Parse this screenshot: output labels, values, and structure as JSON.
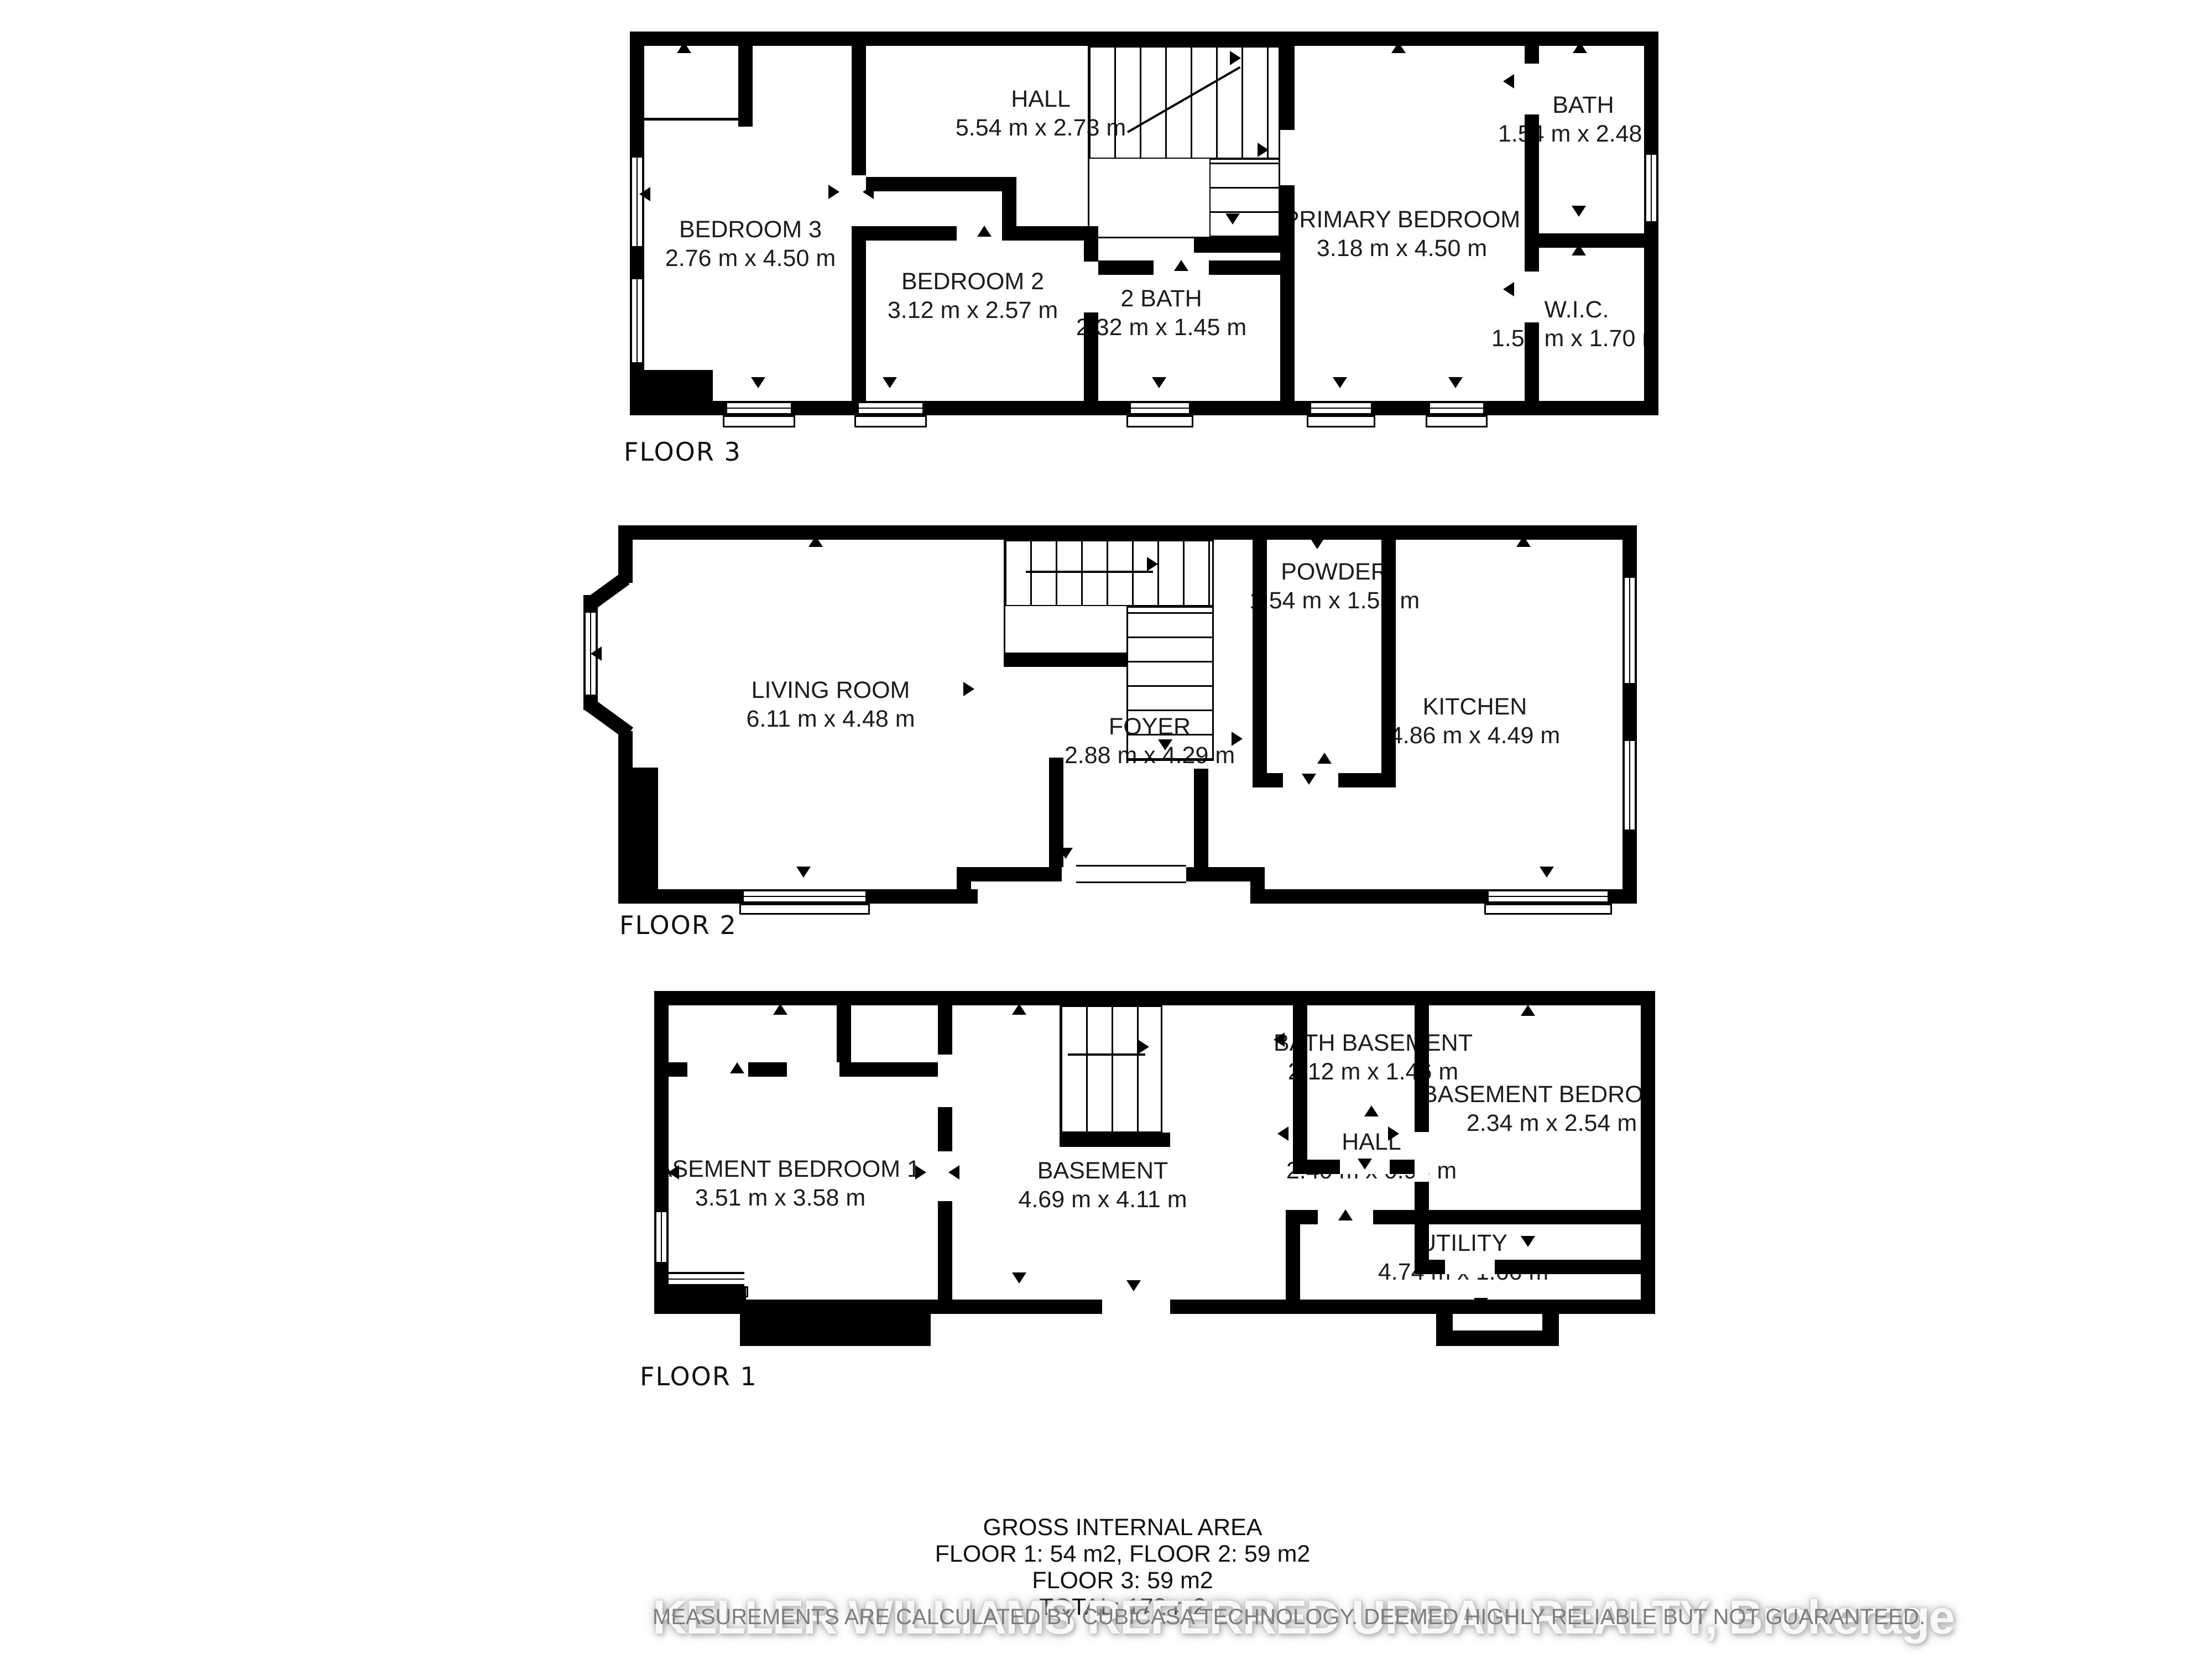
{
  "floors": [
    {
      "label": "FLOOR 3",
      "rooms": [
        {
          "name": "HALL",
          "dims": "5.54 m x 2.73 m"
        },
        {
          "name": "BEDROOM 3",
          "dims": "2.76 m x 4.50 m"
        },
        {
          "name": "BEDROOM 2",
          "dims": "3.12 m x 2.57 m"
        },
        {
          "name": "2 BATH",
          "dims": "2.32 m x 1.45 m"
        },
        {
          "name": "PRIMARY BEDROOM",
          "dims": "3.18 m x 4.50 m"
        },
        {
          "name": "BATH",
          "dims": "1.54 m x 2.48 m"
        },
        {
          "name": "W.I.C.",
          "dims": "1.54 m x 1.70 m"
        }
      ]
    },
    {
      "label": "FLOOR 2",
      "rooms": [
        {
          "name": "LIVING ROOM",
          "dims": "6.11 m x 4.48 m"
        },
        {
          "name": "FOYER",
          "dims": "2.88 m x 4.29 m"
        },
        {
          "name": "POWDER",
          "dims": "1.54 m x 1.55 m"
        },
        {
          "name": "KITCHEN",
          "dims": "4.86 m x 4.49 m"
        }
      ]
    },
    {
      "label": "FLOOR 1",
      "rooms": [
        {
          "name": "BASEMENT BEDROOM 1",
          "dims": "3.51 m x 3.58 m"
        },
        {
          "name": "BASEMENT",
          "dims": "4.69 m x 4.11 m"
        },
        {
          "name": "BATH BASEMENT",
          "dims": "2.12 m x 1.46 m"
        },
        {
          "name": "BASEMENT BEDROOM",
          "dims": "2.34 m x 2.54 m"
        },
        {
          "name": "HALL",
          "dims": "2.40 m x 0.98 m"
        },
        {
          "name": "UTILITY",
          "dims": "4.74 m x 1.66 m"
        }
      ]
    }
  ],
  "summary": {
    "title": "GROSS INTERNAL AREA",
    "floors_1_2": "FLOOR 1: 54 m2, FLOOR 2: 59 m2",
    "floor_3": "FLOOR 3: 59 m2",
    "total": "TOTAL: 172 m2"
  },
  "footer": {
    "disclaimer": "MEASUREMENTS ARE CALCULATED BY CUBICASA TECHNOLOGY. DEEMED HIGHLY RELIABLE BUT NOT GUARANTEED.",
    "watermark": "KELLER WILLIAMS REFERRED URBAN REALTY, Brokerage"
  },
  "colors": {
    "walls": "#000000",
    "background": "#ffffff",
    "room_text": "#1c1c1c",
    "disclaimer_text": "#7d7d7d",
    "watermark_text": "#f8f8f8"
  }
}
